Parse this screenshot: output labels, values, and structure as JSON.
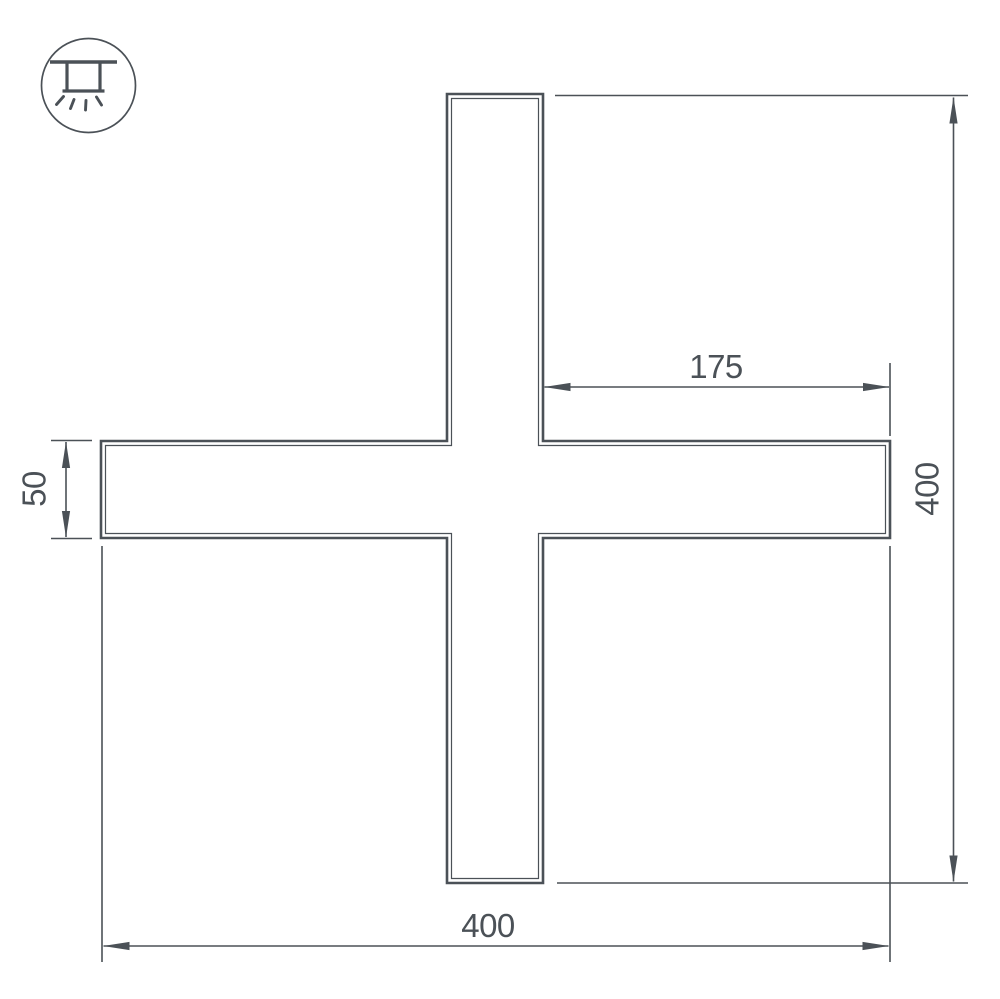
{
  "drawing": {
    "subject": "Cross-shaped linear light profile dimension drawing",
    "line_color": "#4b5157",
    "background_color": "#ffffff",
    "icon": "recessed-ceiling-light",
    "dimensions": {
      "arm_length_top": "175",
      "overall_height_right": "400",
      "profile_width_left": "50",
      "overall_width_bottom": "400"
    }
  }
}
